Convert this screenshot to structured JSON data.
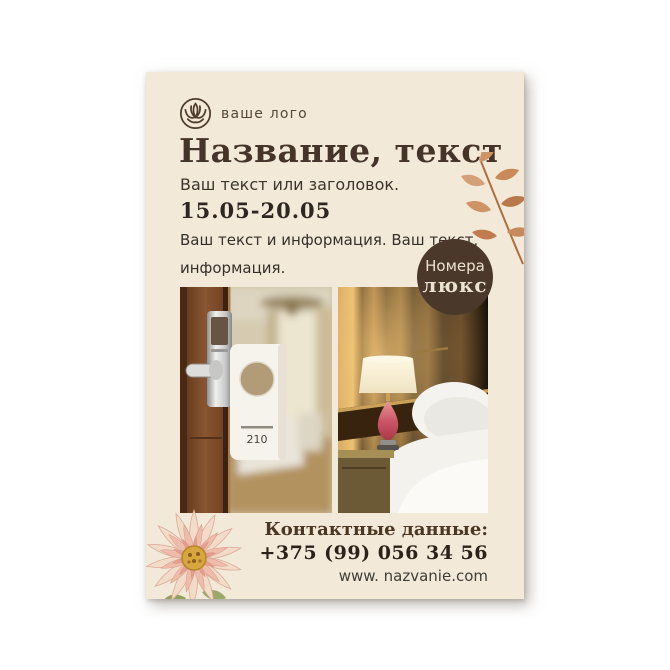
{
  "poster": {
    "logo": {
      "label": "ваше лого",
      "icon": "lotus-flower-icon"
    },
    "title": "Название, текст",
    "subtitle": "Ваш текст или заголовок.",
    "date_range": "15.05-20.05",
    "description": {
      "line1": "Ваш текст и информация. Ваш текст,",
      "line2": "информация."
    },
    "badge": {
      "line1": "Номера",
      "line2": "люкс"
    },
    "door_tag_number": "210",
    "contacts": {
      "heading": "Контактные данные:",
      "phone": "+375 (99) 056 34 56",
      "website": "www. nazvanie.com"
    },
    "colors": {
      "paper": "#f2e9d8",
      "title_brown": "#44342a",
      "badge_brown": "#4a382b",
      "badge_text": "#ece2d0",
      "leaf_terracotta": "#c8875a"
    }
  }
}
